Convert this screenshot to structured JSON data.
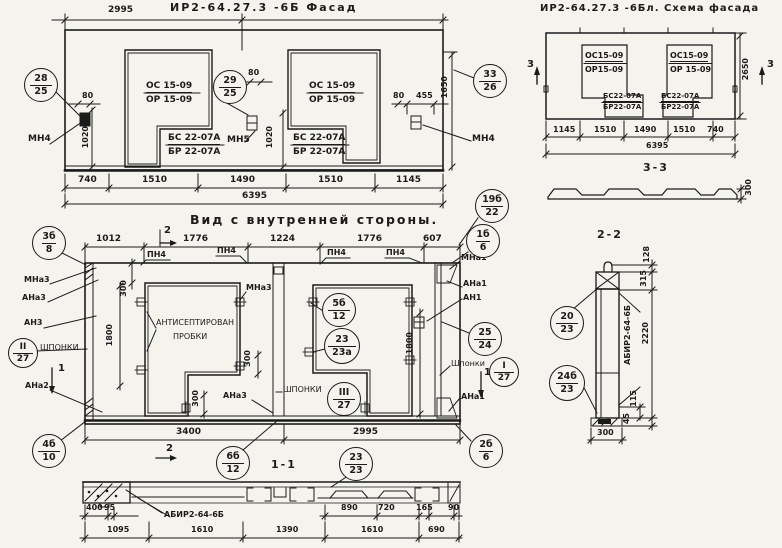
{
  "facade": {
    "title": "ИР2-64.27.3  -6Б   Фасад",
    "dim_2995": "2995",
    "dim_80_left": "80",
    "dim_1020_left": "1020",
    "dim_80_mid": "80",
    "dim_1020_mid": "1020",
    "dim_80_right": "80",
    "dim_455": "455",
    "dim_1650": "1650",
    "window1": {
      "l1": "ОС 15-09",
      "l2": "ОР 15-09",
      "s1": "БС 22-07А",
      "s2": "БР 22-07А"
    },
    "window2": {
      "l1": "ОС 15-09",
      "l2": "ОР 15-09",
      "s1": "БС 22-07А",
      "s2": "БР 22-07А"
    },
    "labels": {
      "mn4": "МН4",
      "mn5": "МН5"
    },
    "callouts": {
      "c28": {
        "top": "28",
        "bot": "25"
      },
      "c29": {
        "top": "29",
        "bot": "25"
      },
      "c33": {
        "top": "33",
        "bot": "26"
      }
    },
    "dims_row1": [
      "740",
      "1510",
      "1490",
      "1510",
      "1145"
    ],
    "dim_total": "6395"
  },
  "schema": {
    "title": "ИР2-64.27.3  -6Бл.  Схема фасада",
    "window1": {
      "l1": "ОС15-09",
      "l2": "ОР15-09",
      "s1": "БС22-07А",
      "s2": "БР22-07А"
    },
    "window2": {
      "l1": "ОС15-09",
      "l2": "ОР 15-09",
      "s1": "БС22-07А",
      "s2": "БР22-07А"
    },
    "dims_row1": [
      "1145",
      "1510",
      "1490",
      "1510",
      "740"
    ],
    "dim_total": "6395",
    "dim_2650": "2650",
    "marker3": "3"
  },
  "section33": {
    "title": "3-3",
    "dim_300": "300"
  },
  "inner": {
    "title": "Вид с внутренней стороны.",
    "dims_top": [
      "1012",
      "1776",
      "1224",
      "1776",
      "607"
    ],
    "pn4": "ПН4",
    "dims_bottom": [
      "3400",
      "2995"
    ],
    "dim_300_a": "300",
    "dim_300_b": "300",
    "dim_300_c": "300",
    "dim_1800_left": "1800",
    "dim_1800_right": "1800",
    "antiseptic_l1": "АНТИСЕПТИРОВАН",
    "antiseptic_l2": "ПРОБКИ",
    "shponki": "ШПОНКИ",
    "shponki_lc": "Шпонки",
    "labels": {
      "mna3": "МНа3",
      "ana3": "АНа3",
      "an3": "АН3",
      "ana2": "АНа2",
      "mna1": "МНа1",
      "ana1": "АНа1",
      "an1": "АН1"
    },
    "marker1": "1",
    "marker2": "2",
    "callouts": {
      "c3b": {
        "top": "3б",
        "bot": "8"
      },
      "c19b": {
        "top": "19б",
        "bot": "22"
      },
      "c1b": {
        "top": "1б",
        "bot": "6"
      },
      "c5b": {
        "top": "5б",
        "bot": "12"
      },
      "c23a": {
        "top": "23",
        "bot": "23а"
      },
      "cI": {
        "top": "I",
        "bot": "27"
      },
      "cII": {
        "top": "II",
        "bot": "27"
      },
      "cIII": {
        "top": "III",
        "bot": "27"
      },
      "c25": {
        "top": "25",
        "bot": "24"
      },
      "c4b": {
        "top": "4б",
        "bot": "10"
      },
      "c6b": {
        "top": "6б",
        "bot": "12"
      },
      "c23": {
        "top": "23",
        "bot": "23"
      },
      "c2b": {
        "top": "2б",
        "bot": "6"
      }
    }
  },
  "section11": {
    "title": "1-1",
    "label": "АБИР2-64-6Б",
    "dims_upper": [
      "400",
      "95",
      "890",
      "720",
      "165",
      "90"
    ],
    "dims_lower": [
      "1095",
      "1610",
      "1390",
      "1610",
      "690"
    ]
  },
  "section22": {
    "title": "2-2",
    "label": "АБИР2-64-6Б",
    "dims": {
      "d128": "128",
      "d315": "315",
      "d2220": "2220",
      "d115": "115",
      "d45": "45",
      "d300": "300"
    },
    "callouts": {
      "c20": {
        "top": "20",
        "bot": "23"
      },
      "c24b": {
        "top": "24б",
        "bot": "23"
      }
    }
  }
}
